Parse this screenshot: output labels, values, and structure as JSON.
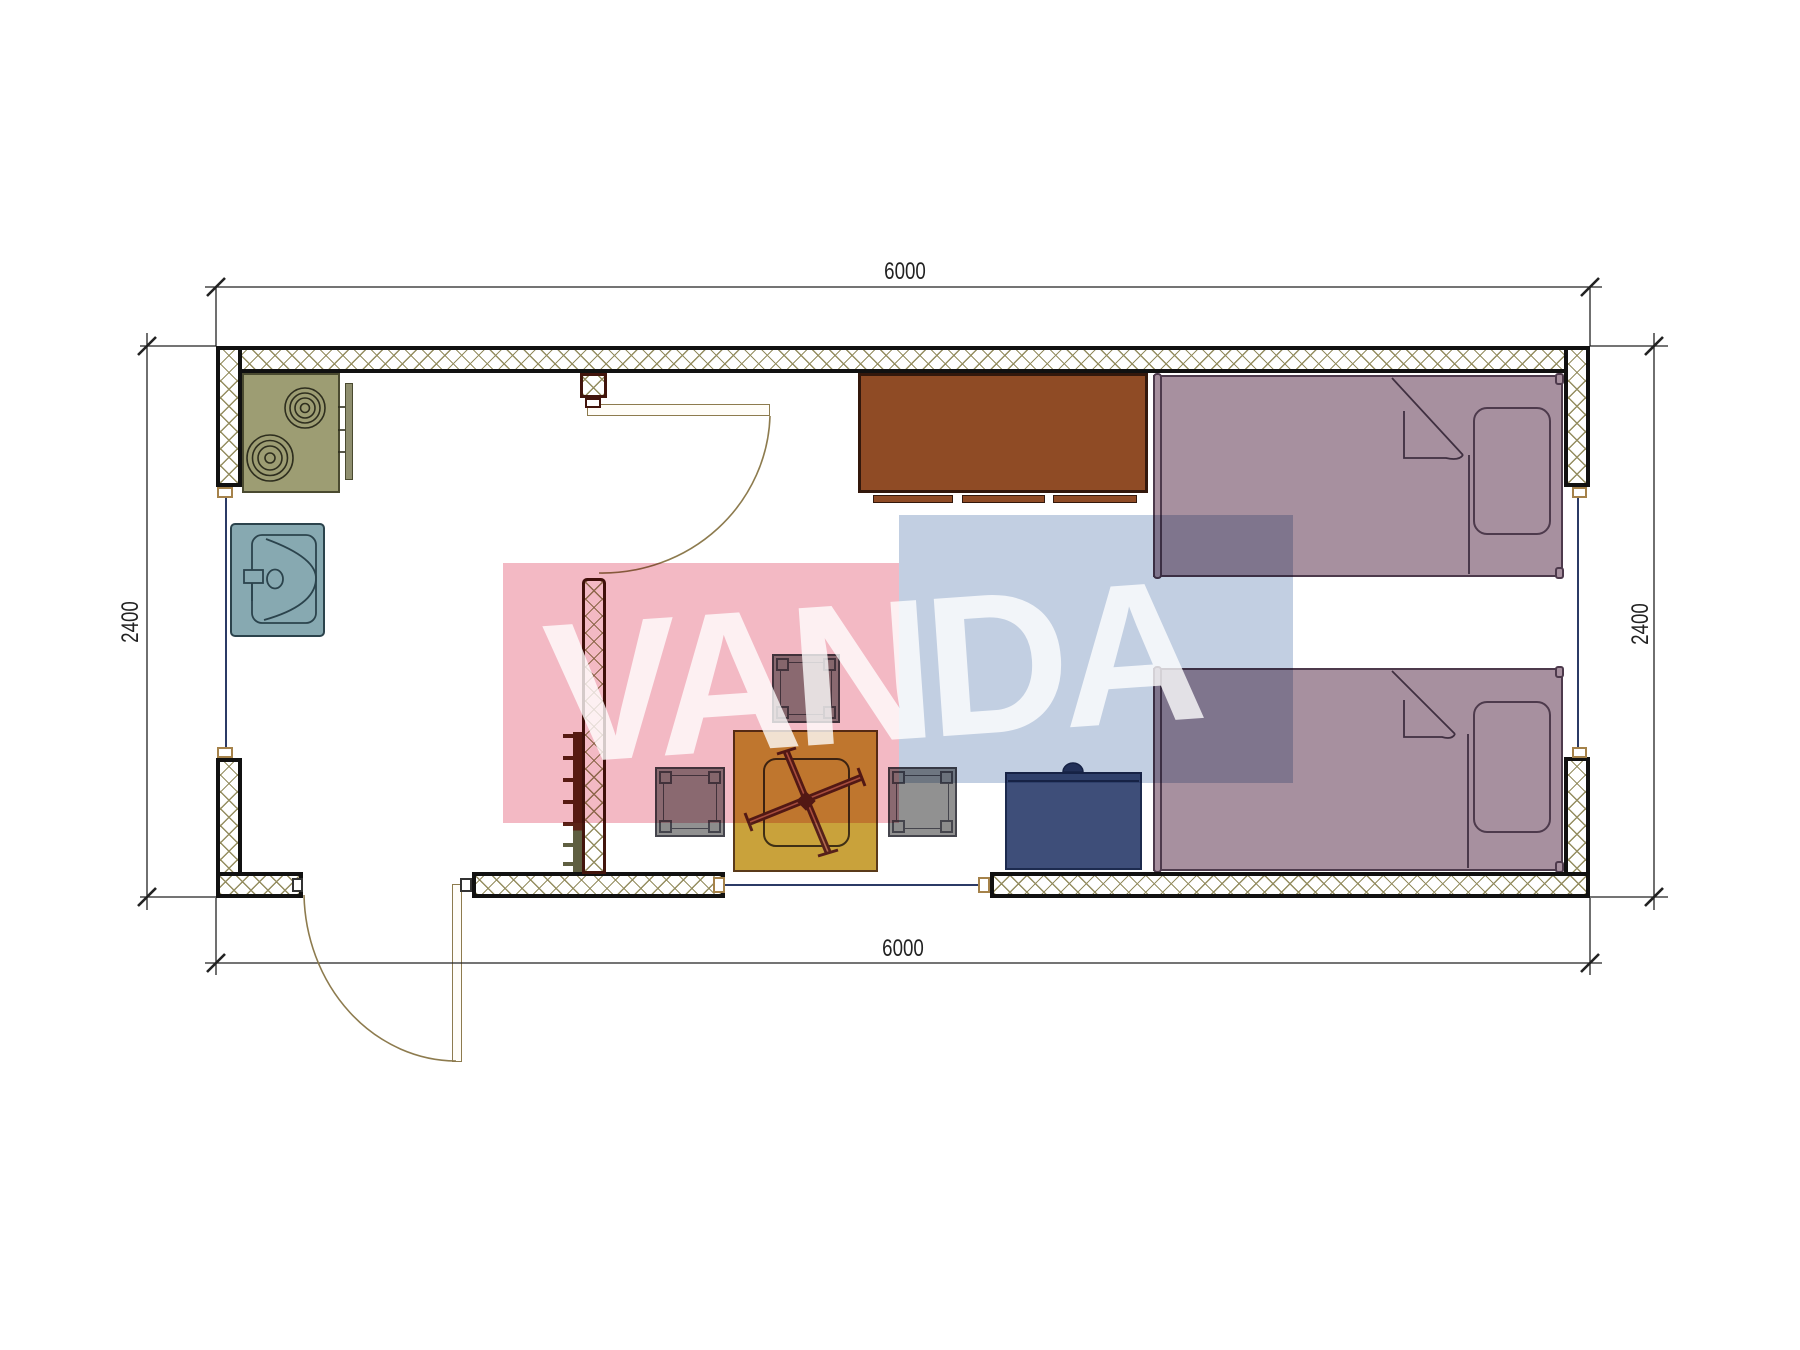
{
  "watermark": {
    "text": "VANDA",
    "pink_block": "#f3b9c4",
    "blue_block": "#c2cfe2",
    "text_color": "rgba(255,255,255,0.78)"
  },
  "dimensions": {
    "top": "6000",
    "bottom": "6000",
    "left": "2400",
    "right": "2400"
  },
  "colors": {
    "wall-line": "#111111",
    "hatch-line": "#948d60",
    "partition-line": "#42150d",
    "bed-fill": "#a7909f",
    "bed-line": "#4d3a4c",
    "desk-fill": "#8f4b25",
    "desk-line": "#33180c",
    "stove-fill": "#9d9d73",
    "stove-line": "#4a4a30",
    "sink-fill": "#87a9b1",
    "sink-line": "#2b434c",
    "navy-fill": "#3e4e79",
    "navy-line": "#1c2a4e",
    "table-fill": "#c9a23b",
    "table-line": "#5a3a1a",
    "stool-fill": "#919191",
    "stool-line": "#45454d",
    "radiator-dark": "#5b2317",
    "radiator-olive": "#5f5f41",
    "glass-line": "#2b3a66",
    "door-line": "#8d7b4e",
    "dim-line": "#222222",
    "cap-window-line": "#a5824a"
  }
}
